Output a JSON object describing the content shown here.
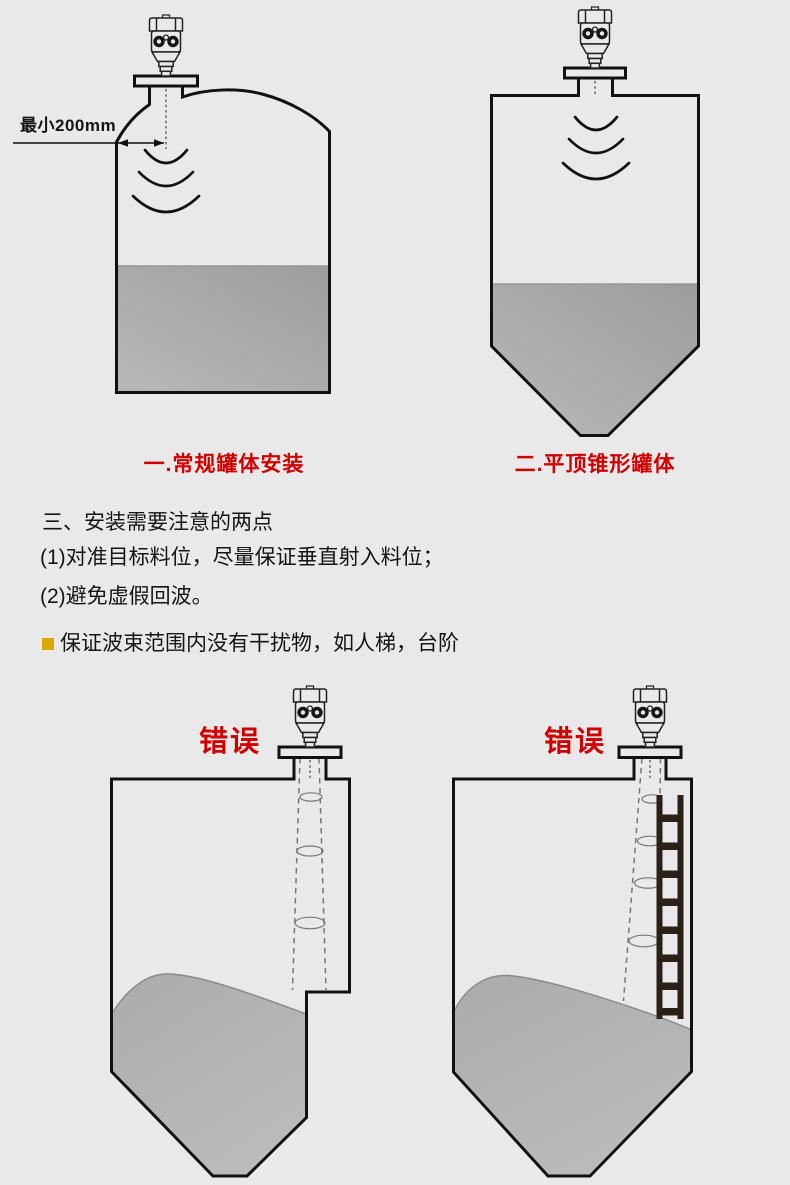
{
  "diagrams": {
    "normal_tank": {
      "caption": "一.常规罐体安装",
      "min_distance_label": "最小200mm"
    },
    "cone_tank": {
      "caption": "二.平顶锥形罐体"
    },
    "wrong_step_tank": {
      "error_label": "错误"
    },
    "wrong_ladder_tank": {
      "error_label": "错误"
    }
  },
  "instructions": {
    "heading": "三、安装需要注意的两点",
    "points": [
      "(1)对准目标料位，尽量保证垂直射入料位；",
      "(2)避免虚假回波。"
    ],
    "note": "保证波束范围内没有干扰物，如人梯，台阶"
  },
  "colors": {
    "background": "#e9e9e9",
    "line": "#111111",
    "accent_red": "#d10000",
    "bullet_yellow": "#d9a800",
    "material_gray": "#aeaeae",
    "ladder_dark": "#2b2018"
  }
}
